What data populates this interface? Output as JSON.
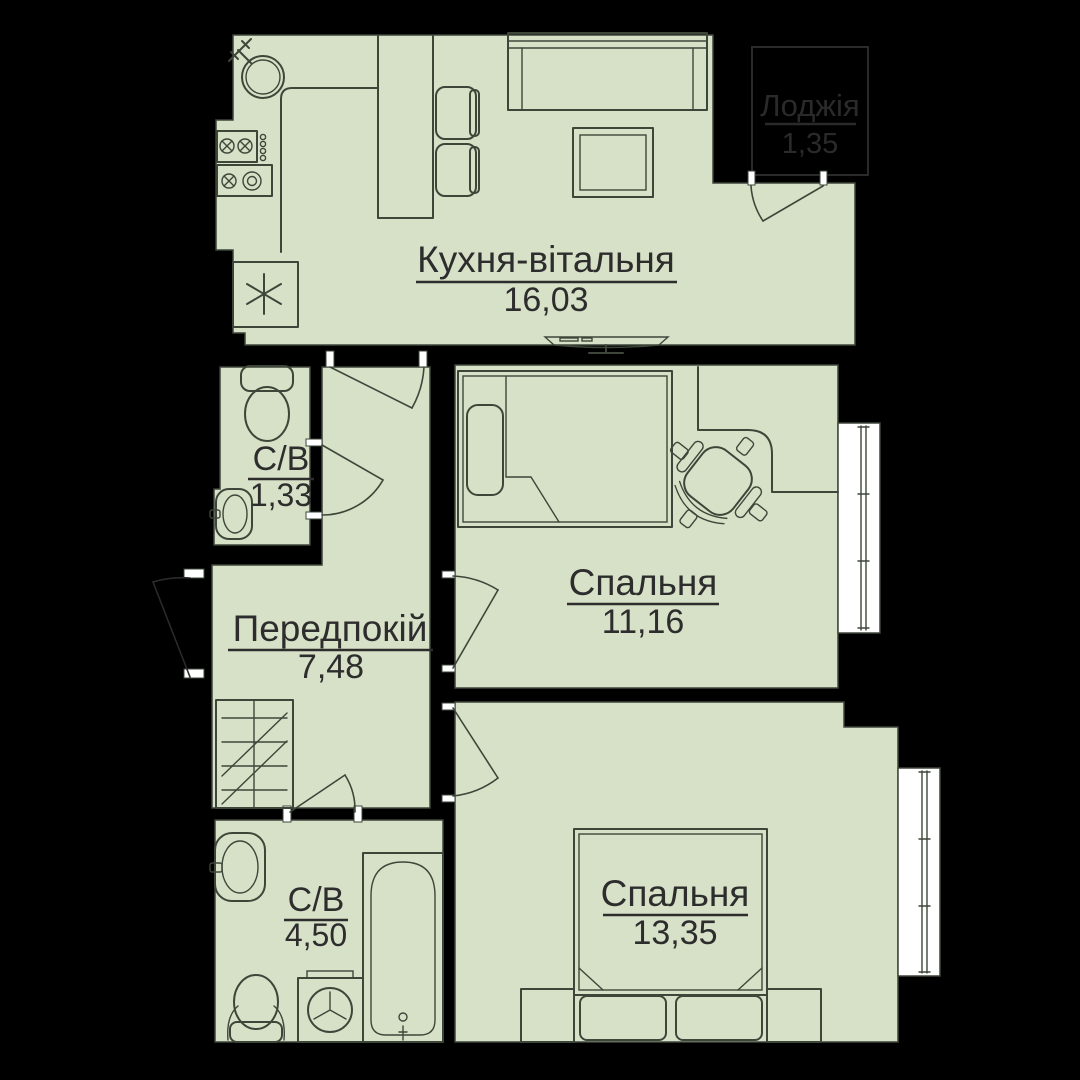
{
  "plan_title": "Apartment floor plan",
  "colors": {
    "background": "#000000",
    "floor": "#d7e1c7",
    "furniture_outline": "#3e463a",
    "label_ink": "#2d2d2d",
    "loggia_ink": "#2a2a2a",
    "window_fill": "#ffffff"
  },
  "rooms": [
    {
      "key": "kitchen-living",
      "name": "Кухня-вітальня",
      "area": "16,03"
    },
    {
      "key": "bathroom-top",
      "name": "С/В",
      "area": "1,33"
    },
    {
      "key": "hallway",
      "name": "Передпокій",
      "area": "7,48"
    },
    {
      "key": "bedroom-1",
      "name": "Спальня",
      "area": "11,16"
    },
    {
      "key": "bathroom-main",
      "name": "С/В",
      "area": "4,50"
    },
    {
      "key": "bedroom-2",
      "name": "Спальня",
      "area": "13,35"
    },
    {
      "key": "loggia",
      "name": "Лоджія",
      "area": "1,35"
    }
  ],
  "furniture_icons": [
    "kitchen-sink-icon",
    "stove-icon",
    "freezer-icon",
    "bar-counter-icon",
    "bar-stool-icon",
    "sofa-icon",
    "coffee-table-icon",
    "tv-icon",
    "toilet-icon",
    "washbasin-icon",
    "wardrobe-icon",
    "bed-icon",
    "desk-icon",
    "office-chair-icon",
    "double-bed-icon",
    "nightstand-icon",
    "washing-machine-icon",
    "bathtub-icon",
    "window-icon",
    "door-swing-icon"
  ]
}
